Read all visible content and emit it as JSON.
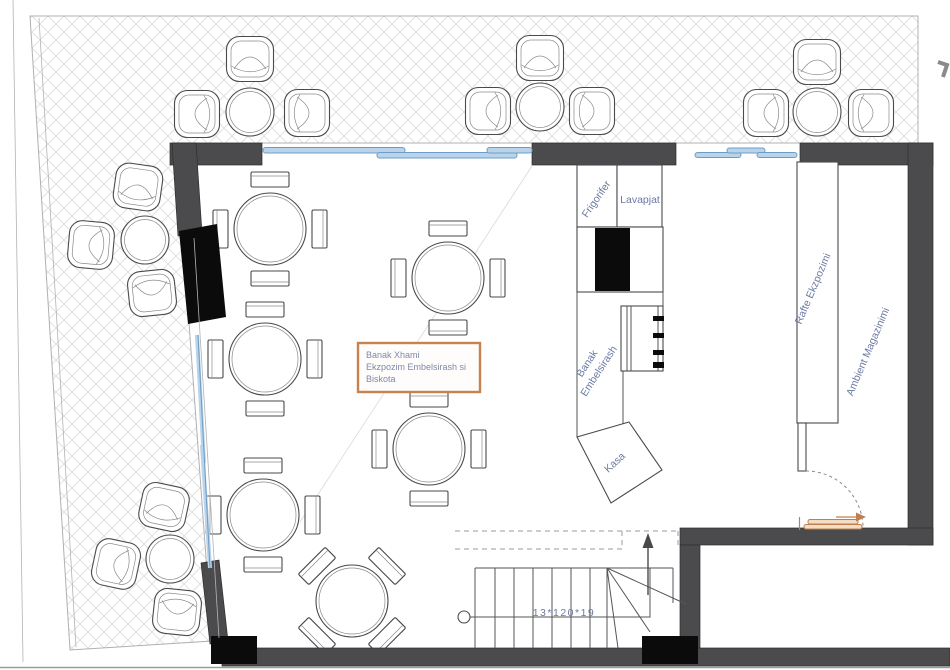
{
  "labels": {
    "annotation_box": {
      "line1": "Banak Xhami",
      "line2": "Ekzpozim Embelsirash si",
      "line3": "Biskota"
    },
    "frigorifer": "Frigorifer",
    "lavapjat": "Lavapjat",
    "banak": {
      "line1": "Banak",
      "line2": "Embelsirash"
    },
    "kasa": "Kasa",
    "rafte_ekzpozimi": "Rafte Ekzpozimi",
    "ambient_magazinimi": "Ambient Magazinimi",
    "stair_dimension": "13*120*19"
  },
  "colors": {
    "wall": "#4b4b4e",
    "black_fixture": "#0b0b0b",
    "window_fill": "#b9d3ea",
    "window_edge": "#6d9dc5",
    "label_blue": "#6b7aa3",
    "annotation_orange": "#c8824f",
    "door_orange": "#bf8050",
    "hatch_line": "#dcdcdc"
  },
  "furniture": {
    "indoor_tables": [
      {
        "x": 270,
        "y": 229,
        "rot": 0
      },
      {
        "x": 448,
        "y": 278,
        "rot": 0
      },
      {
        "x": 265,
        "y": 359,
        "rot": 0
      },
      {
        "x": 429,
        "y": 449,
        "rot": 0
      },
      {
        "x": 263,
        "y": 515,
        "rot": 0
      },
      {
        "x": 352,
        "y": 601,
        "rot": 45
      }
    ],
    "outdoor_tables": [
      {
        "x": 250,
        "y": 112
      },
      {
        "x": 540,
        "y": 107
      },
      {
        "x": 817,
        "y": 112
      },
      {
        "x": 145,
        "y": 240
      },
      {
        "x": 170,
        "y": 559
      }
    ],
    "outdoor_chairs": [
      {
        "x": 250,
        "y": 59,
        "rot": 0
      },
      {
        "x": 197,
        "y": 114,
        "rot": -90
      },
      {
        "x": 307,
        "y": 113,
        "rot": 90
      },
      {
        "x": 540,
        "y": 58,
        "rot": 0
      },
      {
        "x": 488,
        "y": 111,
        "rot": -90
      },
      {
        "x": 592,
        "y": 111,
        "rot": 90
      },
      {
        "x": 817,
        "y": 62,
        "rot": 0
      },
      {
        "x": 766,
        "y": 113,
        "rot": -90
      },
      {
        "x": 871,
        "y": 113,
        "rot": 90
      },
      {
        "x": 138,
        "y": 187,
        "rot": 8
      },
      {
        "x": 91,
        "y": 245,
        "rot": -85
      },
      {
        "x": 152,
        "y": 293,
        "rot": 174
      },
      {
        "x": 164,
        "y": 507,
        "rot": 12
      },
      {
        "x": 116,
        "y": 564,
        "rot": -78
      },
      {
        "x": 177,
        "y": 612,
        "rot": 186
      }
    ]
  }
}
